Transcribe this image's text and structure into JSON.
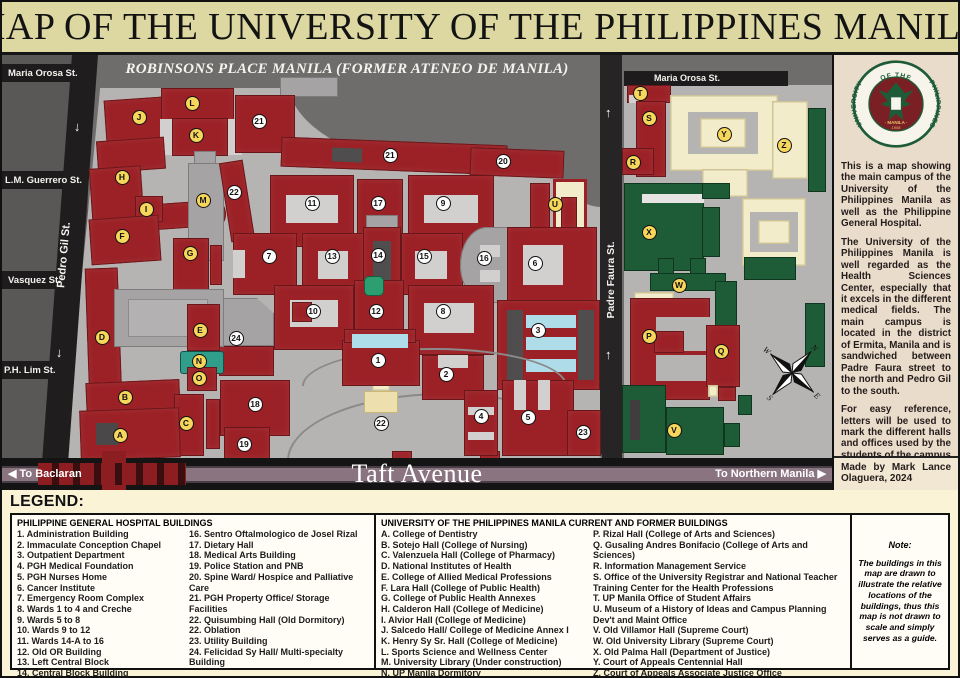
{
  "title": "MAP OF THE UNIVERSITY OF THE PHILIPPINES MANILA",
  "colors": {
    "building_red": "#9b2126",
    "building_green": "#1e5c38",
    "building_cream": "#f2ecca",
    "building_gray": "#a5a3a3",
    "marker_yellow": "#f6d75c",
    "title_bg": "#ddd8a2",
    "legend_bg": "#fbf3d6",
    "sidebar_bg": "#e9dccb",
    "ground": "#b6b3b3",
    "map_bg": "#6f6c6c"
  },
  "map": {
    "robinsons_label": "ROBINSONS PLACE MANILA (FORMER ATENEO DE MANILA)",
    "streets": {
      "maria_orosa_left": "Maria Orosa St.",
      "lm_guerrero": "L.M. Guerrero St.",
      "vasquez": "Vasquez St.",
      "ph_lim": "P.H. Lim St.",
      "pedro_gil": "Pedro Gil St.",
      "padre_faura": "Padre Faura St.",
      "maria_orosa_right": "Maria Orosa St."
    },
    "taft": {
      "name": "Taft Avenue",
      "to_left": "◀ To Baclaran",
      "to_right": "To Northern Manila ▶"
    },
    "compass": [
      "N",
      "E",
      "S",
      "W"
    ],
    "markers": [
      {
        "label": "A",
        "x": 118,
        "y": 380,
        "type": "letter"
      },
      {
        "label": "B",
        "x": 123,
        "y": 342,
        "type": "letter"
      },
      {
        "label": "C",
        "x": 184,
        "y": 368,
        "type": "letter"
      },
      {
        "label": "D",
        "x": 100,
        "y": 282,
        "type": "letter"
      },
      {
        "label": "E",
        "x": 198,
        "y": 275,
        "type": "letter"
      },
      {
        "label": "F",
        "x": 120,
        "y": 181,
        "type": "letter"
      },
      {
        "label": "G",
        "x": 188,
        "y": 198,
        "type": "letter"
      },
      {
        "label": "H",
        "x": 120,
        "y": 122,
        "type": "letter"
      },
      {
        "label": "I",
        "x": 144,
        "y": 154,
        "type": "letter"
      },
      {
        "label": "J",
        "x": 137,
        "y": 62,
        "type": "letter"
      },
      {
        "label": "K",
        "x": 194,
        "y": 80,
        "type": "letter"
      },
      {
        "label": "L",
        "x": 190,
        "y": 48,
        "type": "letter"
      },
      {
        "label": "M",
        "x": 201,
        "y": 145,
        "type": "letter"
      },
      {
        "label": "N",
        "x": 197,
        "y": 306,
        "type": "letter"
      },
      {
        "label": "O",
        "x": 197,
        "y": 323,
        "type": "letter"
      },
      {
        "label": "P",
        "x": 647,
        "y": 281,
        "type": "letter"
      },
      {
        "label": "Q",
        "x": 719,
        "y": 296,
        "type": "letter"
      },
      {
        "label": "R",
        "x": 631,
        "y": 107,
        "type": "letter"
      },
      {
        "label": "S",
        "x": 647,
        "y": 63,
        "type": "letter"
      },
      {
        "label": "T",
        "x": 638,
        "y": 38,
        "type": "letter"
      },
      {
        "label": "U",
        "x": 553,
        "y": 149,
        "type": "letter"
      },
      {
        "label": "V",
        "x": 672,
        "y": 375,
        "type": "letter"
      },
      {
        "label": "W",
        "x": 677,
        "y": 230,
        "type": "letter"
      },
      {
        "label": "X",
        "x": 647,
        "y": 177,
        "type": "letter"
      },
      {
        "label": "Y",
        "x": 722,
        "y": 79,
        "type": "letter"
      },
      {
        "label": "Z",
        "x": 782,
        "y": 90,
        "type": "letter"
      },
      {
        "label": "1",
        "x": 376,
        "y": 305,
        "type": "number"
      },
      {
        "label": "2",
        "x": 444,
        "y": 319,
        "type": "number"
      },
      {
        "label": "3",
        "x": 536,
        "y": 275,
        "type": "number"
      },
      {
        "label": "4",
        "x": 479,
        "y": 361,
        "type": "number"
      },
      {
        "label": "5",
        "x": 526,
        "y": 362,
        "type": "number"
      },
      {
        "label": "6",
        "x": 533,
        "y": 208,
        "type": "number"
      },
      {
        "label": "7",
        "x": 267,
        "y": 201,
        "type": "number"
      },
      {
        "label": "8",
        "x": 441,
        "y": 256,
        "type": "number"
      },
      {
        "label": "9",
        "x": 441,
        "y": 148,
        "type": "number"
      },
      {
        "label": "10",
        "x": 311,
        "y": 256,
        "type": "number"
      },
      {
        "label": "11",
        "x": 310,
        "y": 148,
        "type": "number"
      },
      {
        "label": "12",
        "x": 374,
        "y": 256,
        "type": "number"
      },
      {
        "label": "13",
        "x": 330,
        "y": 201,
        "type": "number"
      },
      {
        "label": "14",
        "x": 376,
        "y": 200,
        "type": "number"
      },
      {
        "label": "15",
        "x": 422,
        "y": 201,
        "type": "number"
      },
      {
        "label": "16",
        "x": 482,
        "y": 203,
        "type": "number"
      },
      {
        "label": "17",
        "x": 376,
        "y": 148,
        "type": "number"
      },
      {
        "label": "18",
        "x": 253,
        "y": 349,
        "type": "number"
      },
      {
        "label": "19",
        "x": 242,
        "y": 389,
        "type": "number"
      },
      {
        "label": "20",
        "x": 501,
        "y": 106,
        "type": "number"
      },
      {
        "label": "21",
        "x": 257,
        "y": 66,
        "type": "number"
      },
      {
        "label": "21",
        "x": 388,
        "y": 100,
        "type": "number"
      },
      {
        "label": "22",
        "x": 232,
        "y": 137,
        "type": "number"
      },
      {
        "label": "22",
        "x": 379,
        "y": 368,
        "type": "number"
      },
      {
        "label": "23",
        "x": 581,
        "y": 377,
        "type": "number"
      },
      {
        "label": "24",
        "x": 234,
        "y": 283,
        "type": "number"
      }
    ]
  },
  "sidebar": {
    "seal": {
      "arc_left": "UNIVERSITY",
      "arc_top": "OF THE",
      "arc_right": "PHILIPPINES",
      "bottom": "· MANILA ·",
      "year": "1908"
    },
    "paragraphs": [
      "This is a map showing the main campus of the University of the Philippines Manila as well as the Philippine General Hospital.",
      "The University of the Philippines Manila is well regarded as the Health Sciences Center, especially that it excels in the different medical fields. The main campus is located in the district of Ermita, Manila and is sandwiched between Padre Faura street to the north and Pedro Gil to the south.",
      "For easy reference, letters will be used to mark the different halls and offices used by the students of the campus while numbers will be used to mark the hospital buildings of the Philippine General Hospital. The legend for all of these can be found below."
    ],
    "credit": "Made by Mark Lance Olaguera, 2024"
  },
  "legend": {
    "title": "LEGEND:",
    "pgh": {
      "header": "PHILIPPINE GENERAL HOSPITAL BUILDINGS",
      "col1": [
        "1. Administration Building",
        "2. Immaculate Conception Chapel",
        "3. Outpatient Department",
        "4. PGH Medical Foundation",
        "5. PGH Nurses Home",
        "6. Cancer Institute",
        "7. Emergency Room Complex",
        "8. Wards 1 to 4 and Creche",
        "9. Wards 5 to 8",
        "10. Wards 9 to 12",
        "11. Wards 14-A to 16",
        "12. Old OR Building",
        "13. Left Central Block",
        "14. Central Block Building",
        "15. Right Central Block"
      ],
      "col2": [
        "16. Sentro Oftalmologico de Josel Rizal",
        "17. Dietary Hall",
        "18. Medical Arts Building",
        "19. Police Station and PNB",
        "20. Spine Ward/ Hospice and Palliative Care",
        "21. PGH Property Office/ Storage Facilities",
        "22. Quisumbing Hall (Old Dormitory)",
        "22. Oblation",
        "23. Utility Building",
        "24. Felicidad Sy Hall/ Multi-specialty Building"
      ]
    },
    "upm": {
      "header": "UNIVERSITY OF THE PHILIPPINES MANILA CURRENT AND FORMER BUILDINGS",
      "col1": [
        "A. College of Dentistry",
        "B. Sotejo Hall (College of Nursing)",
        "C. Valenzuela Hall (College of Pharmacy)",
        "D. National Institutes of Health",
        "E. College of Allied Medical Professions",
        "F. Lara Hall (College of Public Health)",
        "G. College of Public Health Annexes",
        "H. Calderon Hall (College of Medicine)",
        "I. Alvior Hall (College of Medicine)",
        "J. Salcedo Hall/ College of Medicine Annex I",
        "K. Henry Sy Sr. Hall (College of Medicine)",
        "L. Sports Science and Wellness Center",
        "M. University Library (Under construction)",
        "N. UP Manila Dormitory",
        "O. Phi House"
      ],
      "col2": [
        "P. Rizal Hall (College of Arts and Sciences)",
        "Q. Gusaling Andres Bonifacio (College of Arts and Sciences)",
        "R. Information Management Service",
        "S. Office of the University Registrar and National Teacher Training Center for the Health Professions",
        "T. UP Manila Office of Student Affairs",
        "U. Museum of a History of Ideas and Campus Planning Dev't and Maint Office",
        "V. Old Villamor Hall (Supreme Court)",
        "W. Old University Library (Supreme Court)",
        "X. Old Palma Hall (Department of Justice)",
        "Y. Court of Appeals Centennial Hall",
        "Z. Court of Appeals Associate Justice Office"
      ]
    },
    "note": {
      "title": "Note:",
      "body": "The buildings in this map are drawn to illustrate the relative locations of the buildings, thus this map is not drawn to scale and simply serves as a guide."
    }
  }
}
